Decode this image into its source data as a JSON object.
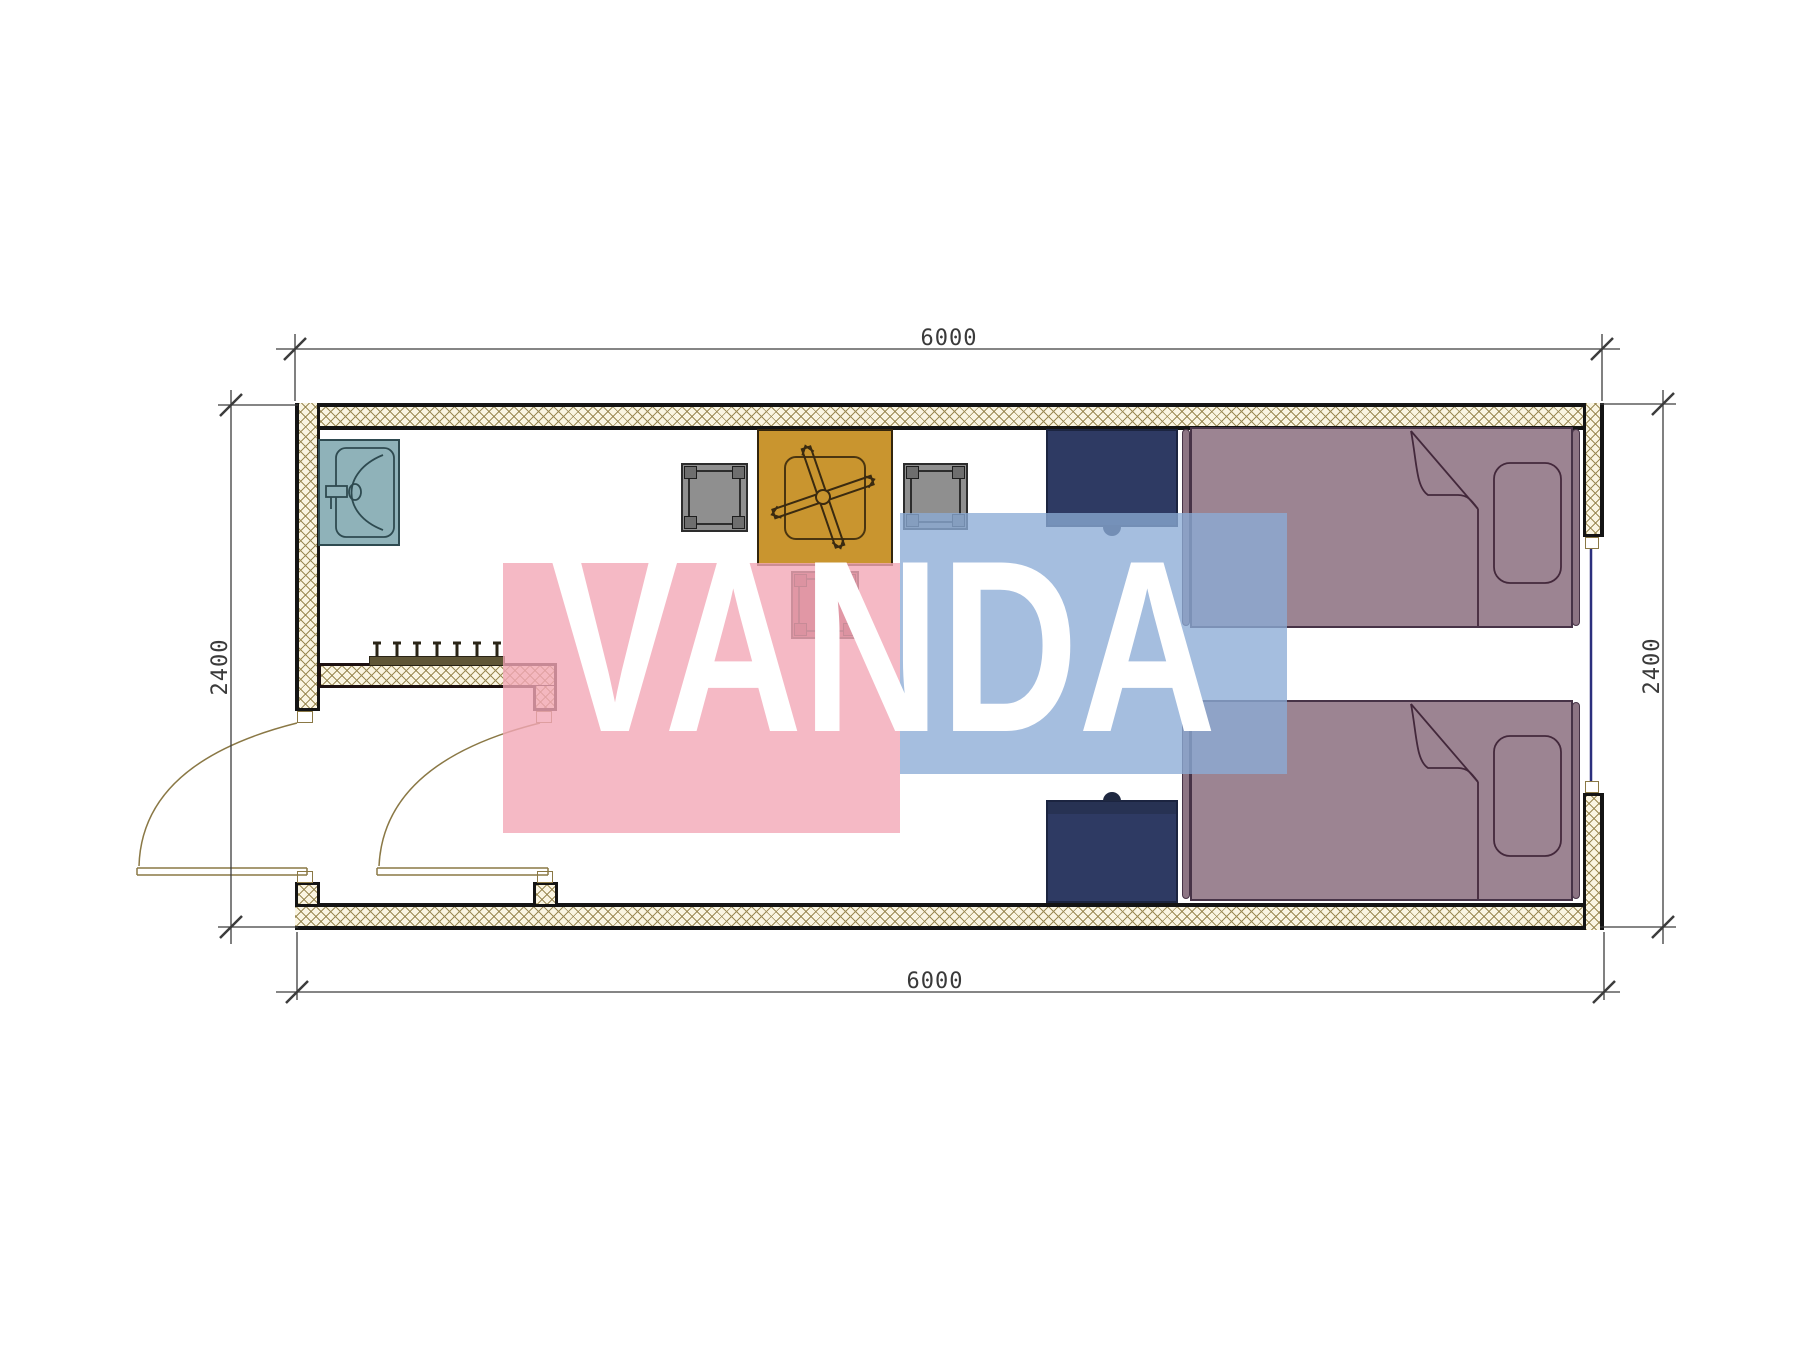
{
  "title": "container-room-floor-plan",
  "watermark": {
    "text": "VANDA",
    "pink_color": "#f2a8b8",
    "blue_color": "#8cacd6",
    "text_color": "#ffffff"
  },
  "dimensions": {
    "top": "6000",
    "bottom": "6000",
    "left": "2400",
    "right": "2400"
  },
  "plan": {
    "walls": {
      "hatch_background": "#faf5e2",
      "hatch_line_color": "#9b8a55",
      "edge_color": "#141414"
    },
    "openings": [
      {
        "name": "door-left",
        "type": "swing-door",
        "line_color": "#8a7845"
      },
      {
        "name": "door-middle",
        "type": "swing-door",
        "line_color": "#8a7845"
      },
      {
        "name": "window-right",
        "type": "window",
        "line_color": "#2b2f7d"
      }
    ],
    "furniture": [
      {
        "name": "sink",
        "color": "#8fb2b9"
      },
      {
        "name": "coat-hooks",
        "color": "#5f5636",
        "hook_count": 7
      },
      {
        "name": "table-with-fan",
        "color": "#c9952f"
      },
      {
        "name": "chair-left",
        "color": "#8f8f8f"
      },
      {
        "name": "chair-right",
        "color": "#8f8f8f"
      },
      {
        "name": "chair-front",
        "color": "#9c5560"
      },
      {
        "name": "nightstand-top",
        "color": "#2e3a63"
      },
      {
        "name": "nightstand-bottom",
        "color": "#2e3a63"
      },
      {
        "name": "bed-top",
        "color": "#9c8492"
      },
      {
        "name": "bed-bottom",
        "color": "#9c8492"
      }
    ]
  }
}
